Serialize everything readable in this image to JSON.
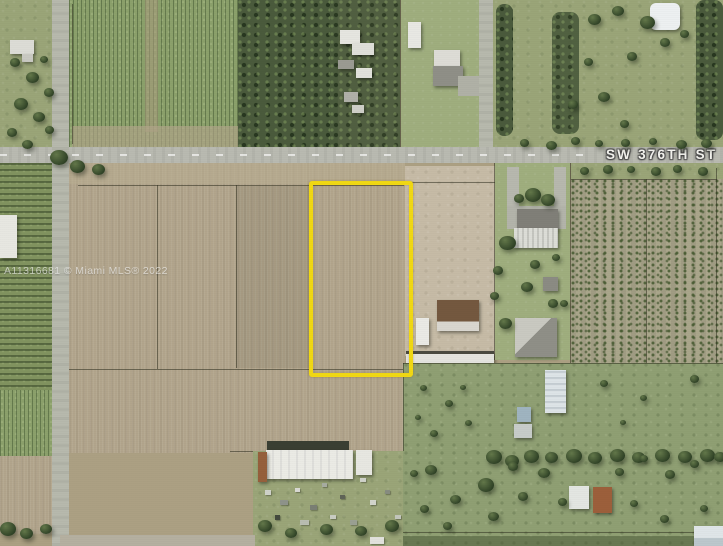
{
  "photo": {
    "street_label": "SW 376TH ST",
    "watermark": "A11316681 © Miami MLS® 2022",
    "parcel_outline_color": "#F1D813",
    "road_color": "#B9BAB1"
  }
}
